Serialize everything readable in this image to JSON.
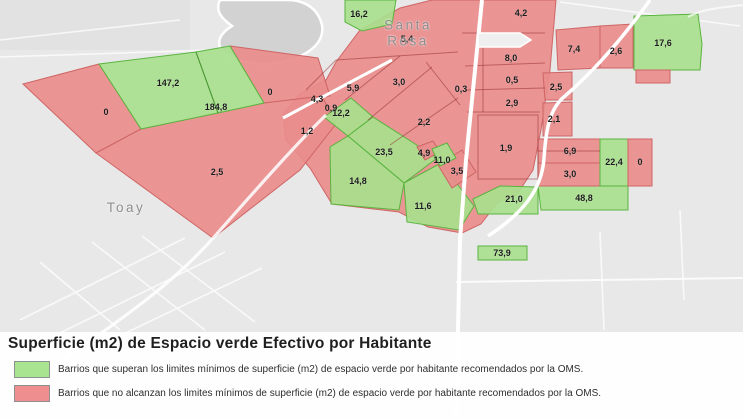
{
  "title": "Superficie (m2) de Espacio verde Efectivo por Habitante",
  "legend": {
    "items": [
      {
        "status": "green",
        "color": "#a9e491",
        "label": "Barrios que superan los limites mínimos de superficie (m2) de espacio verde por habitante recomendados por la OMS."
      },
      {
        "status": "red",
        "color": "#ef8e8e",
        "label": "Barrios que no alcanzan los limites mínimos de superficie (m2) de espacio verde por habitante recomendados por la OMS."
      }
    ]
  },
  "map": {
    "cities": [
      {
        "name": "Santa Rosa",
        "x": 408,
        "y": 33
      },
      {
        "name": "Toay",
        "x": 126,
        "y": 208
      }
    ],
    "colors": {
      "green_fill": "#a8e08d",
      "green_border": "#5ab43f",
      "red_fill": "#e98c8c",
      "red_border": "#cf6565",
      "background": "#e8e8e8",
      "water": "#d2d2d2",
      "road": "#ffffff"
    },
    "areas": [
      {
        "value": "16,2",
        "status": "green",
        "x": 359,
        "y": 14
      },
      {
        "value": "4,2",
        "status": "red",
        "x": 521,
        "y": 13
      },
      {
        "value": "5,4",
        "status": "red",
        "x": 407,
        "y": 39
      },
      {
        "value": "5,9",
        "status": "red",
        "x": 353,
        "y": 88
      },
      {
        "value": "3,0",
        "status": "red",
        "x": 399,
        "y": 82
      },
      {
        "value": "0,3",
        "status": "red",
        "x": 461,
        "y": 89
      },
      {
        "value": "147,2",
        "status": "green",
        "x": 168,
        "y": 83
      },
      {
        "value": "184,8",
        "status": "green",
        "x": 216,
        "y": 107
      },
      {
        "value": "0",
        "status": "red",
        "x": 106,
        "y": 112
      },
      {
        "value": "0",
        "status": "red",
        "x": 270,
        "y": 92
      },
      {
        "value": "2,5",
        "status": "red",
        "x": 217,
        "y": 172
      },
      {
        "value": "4,3",
        "status": "red",
        "x": 317,
        "y": 99
      },
      {
        "value": "0,9",
        "status": "red",
        "x": 331,
        "y": 108
      },
      {
        "value": "1,2",
        "status": "red",
        "x": 307,
        "y": 131
      },
      {
        "value": "12,2",
        "status": "green",
        "x": 341,
        "y": 113
      },
      {
        "value": "23,5",
        "status": "green",
        "x": 384,
        "y": 152
      },
      {
        "value": "4,9",
        "status": "red",
        "x": 424,
        "y": 153
      },
      {
        "value": "11,0",
        "status": "green",
        "x": 442,
        "y": 160
      },
      {
        "value": "3,5",
        "status": "red",
        "x": 457,
        "y": 171
      },
      {
        "value": "14,8",
        "status": "green",
        "x": 358,
        "y": 181
      },
      {
        "value": "11,6",
        "status": "green",
        "x": 423,
        "y": 206
      },
      {
        "value": "8,0",
        "status": "red",
        "x": 511,
        "y": 58
      },
      {
        "value": "0,5",
        "status": "red",
        "x": 512,
        "y": 80
      },
      {
        "value": "2,9",
        "status": "red",
        "x": 512,
        "y": 103
      },
      {
        "value": "2,2",
        "status": "red",
        "x": 424,
        "y": 122
      },
      {
        "value": "1,9",
        "status": "red",
        "x": 506,
        "y": 148
      },
      {
        "value": "2,5",
        "status": "red",
        "x": 556,
        "y": 87
      },
      {
        "value": "2,1",
        "status": "red",
        "x": 554,
        "y": 119
      },
      {
        "value": "7,4",
        "status": "red",
        "x": 574,
        "y": 49
      },
      {
        "value": "2,6",
        "status": "red",
        "x": 616,
        "y": 51
      },
      {
        "value": "17,6",
        "status": "green",
        "x": 663,
        "y": 43
      },
      {
        "value": "6,9",
        "status": "red",
        "x": 570,
        "y": 151
      },
      {
        "value": "3,0",
        "status": "red",
        "x": 570,
        "y": 174
      },
      {
        "value": "22,4",
        "status": "green",
        "x": 614,
        "y": 162
      },
      {
        "value": "0",
        "status": "red",
        "x": 640,
        "y": 162
      },
      {
        "value": "48,8",
        "status": "green",
        "x": 584,
        "y": 198
      },
      {
        "value": "21,0",
        "status": "green",
        "x": 514,
        "y": 199
      },
      {
        "value": "73,9",
        "status": "green",
        "x": 502,
        "y": 253
      }
    ]
  }
}
